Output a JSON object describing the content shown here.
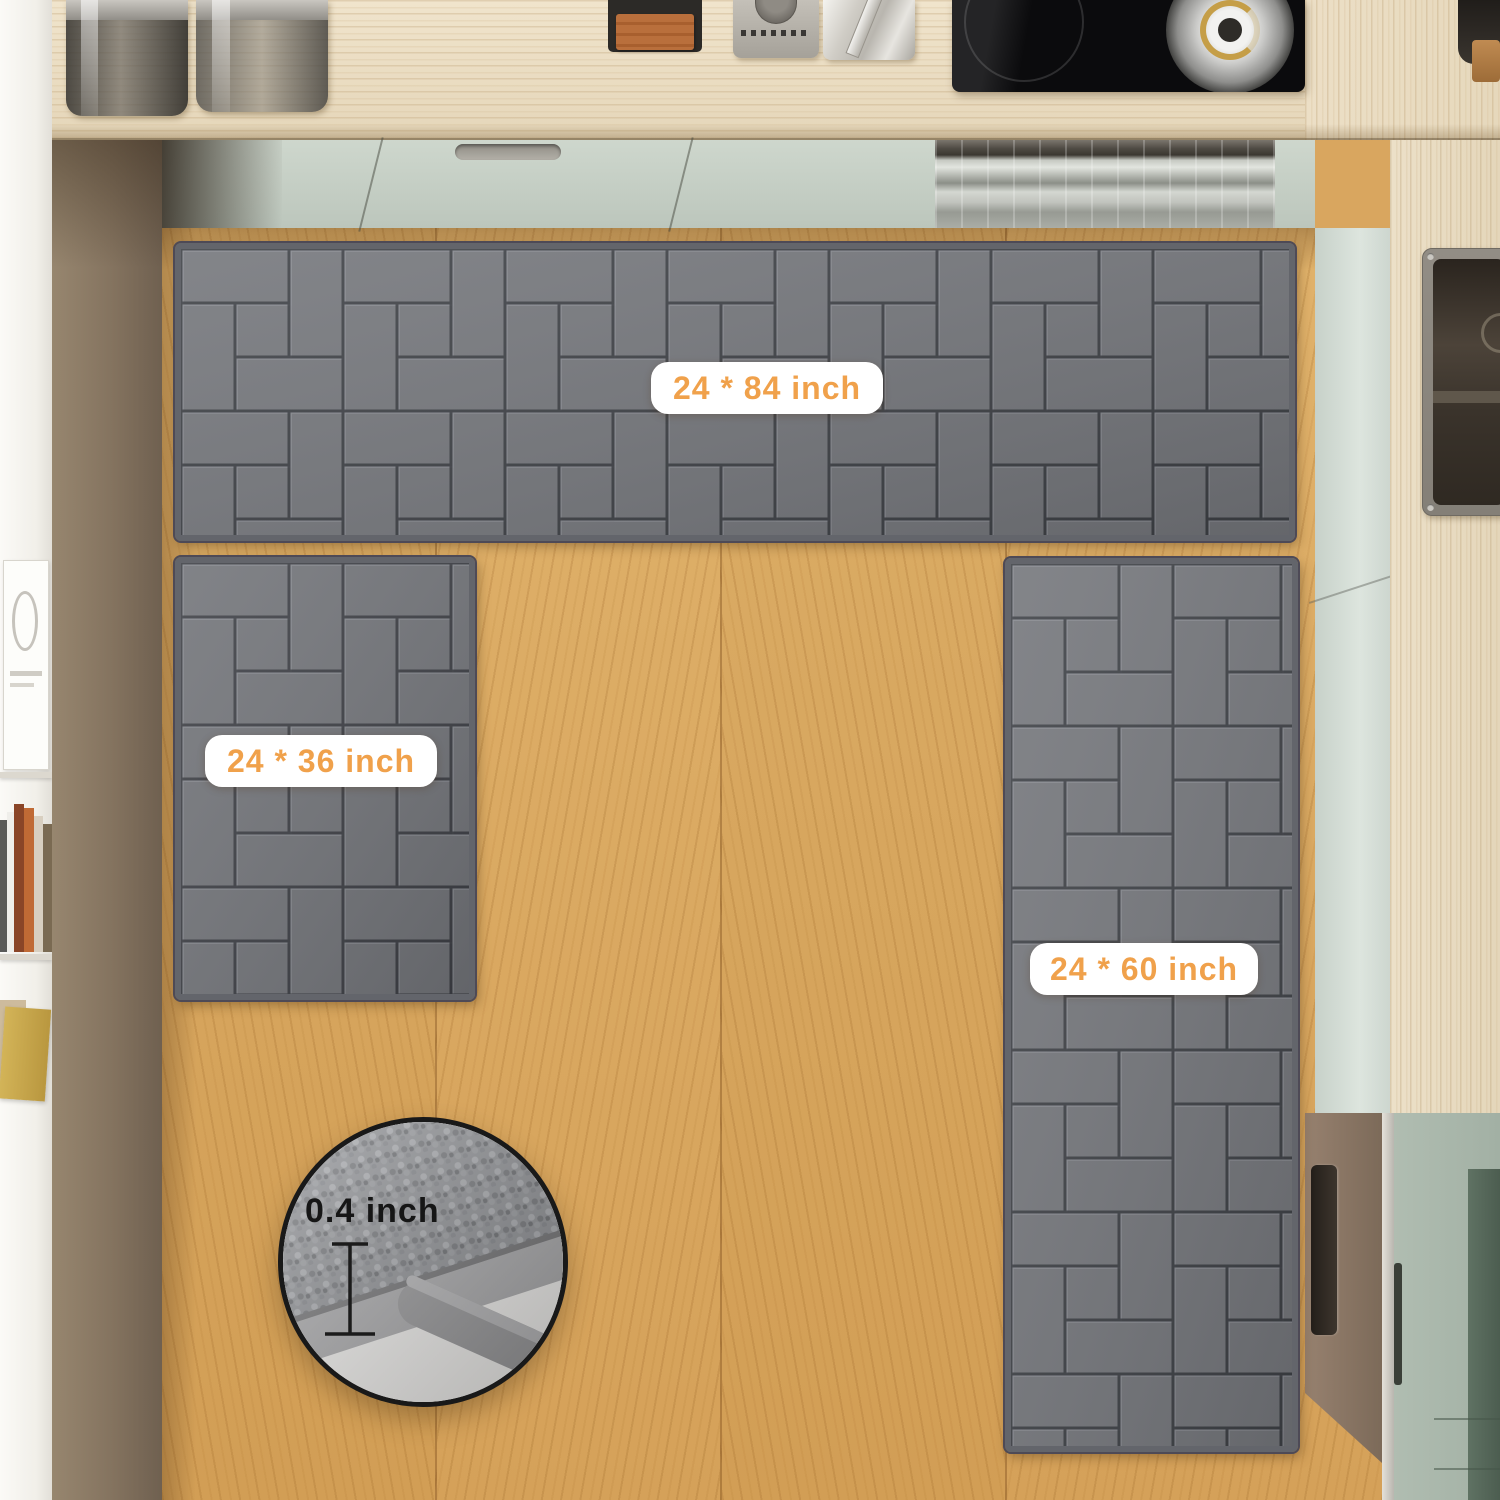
{
  "labels": {
    "runner_top": {
      "text": "24 * 84 inch"
    },
    "mat_left": {
      "text": "24 * 36 inch"
    },
    "runner_right": {
      "text": "24 * 60 inch"
    },
    "thickness": {
      "text": "0.4 inch"
    }
  },
  "colors": {
    "label_accent": "#F0A14B",
    "label_background": "#FFFFFF",
    "rug_base": "#75777C",
    "rug_pattern_line": "#35373D",
    "floor_wood": "#D9A65F",
    "counter_wood": "#EADCC2",
    "cabinet_mint": "#C6D0C7",
    "cabinet_green": "#A9B7AB",
    "cabinet_brown": "#8B7465",
    "wall_taupe": "#84735F",
    "inset_border": "#191919"
  }
}
